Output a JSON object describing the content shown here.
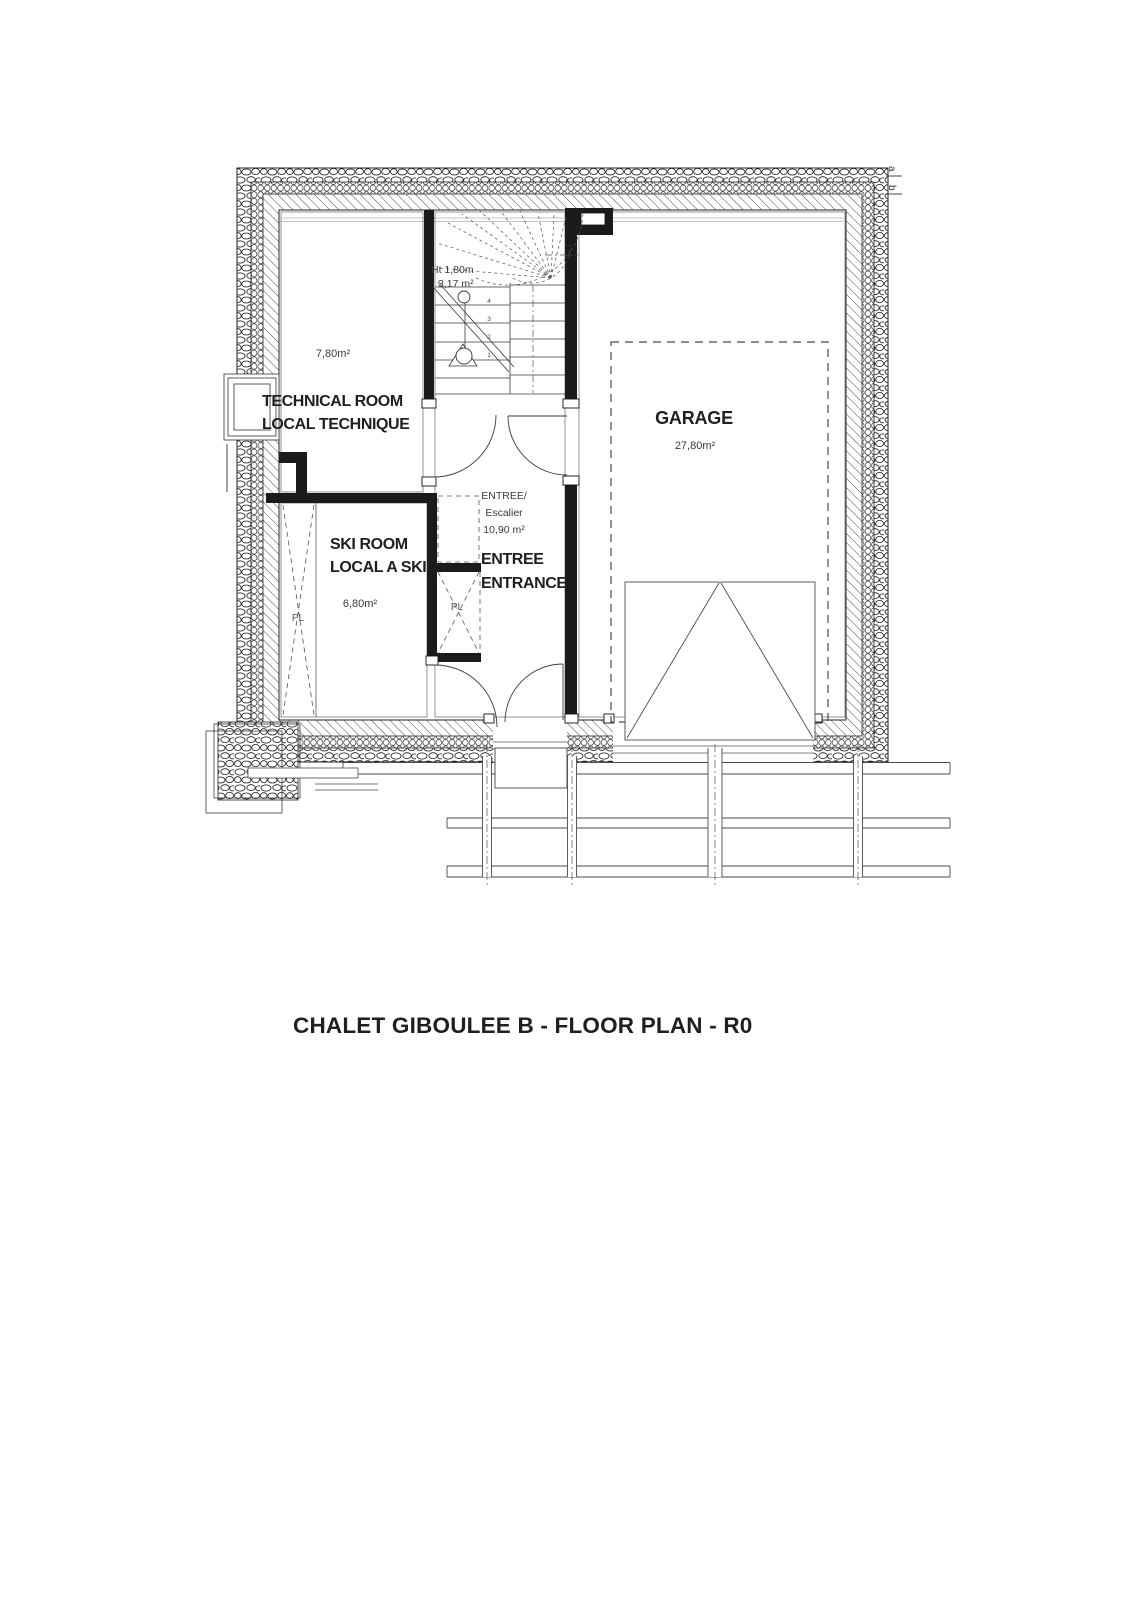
{
  "title": "CHALET GIBOULEE B - FLOOR PLAN - R0",
  "plan": {
    "rooms": {
      "technical": {
        "name_en": "TECHNICAL ROOM",
        "name_fr": "LOCAL TECHNIQUE",
        "area": "7,80m²"
      },
      "ski": {
        "name_en": "SKI ROOM",
        "name_fr": "LOCAL A SKI",
        "area": "6,80m²"
      },
      "hall": {
        "zone_label_line1": "ENTREE/",
        "zone_label_line2": "Escalier",
        "zone_area": "10,90 m²",
        "name_fr": "ENTREE",
        "name_en": "ENTRANCE"
      },
      "garage": {
        "name": "GARAGE",
        "area": "27,80m²"
      }
    },
    "stair": {
      "height_note": "Ht 1,80m",
      "area": "3,17 m²",
      "steps": [
        "1",
        "2",
        "3",
        "4"
      ]
    },
    "closets": {
      "left": "PL",
      "right": "PL"
    },
    "section_marks": {
      "top": "a",
      "bottom": "b"
    }
  }
}
